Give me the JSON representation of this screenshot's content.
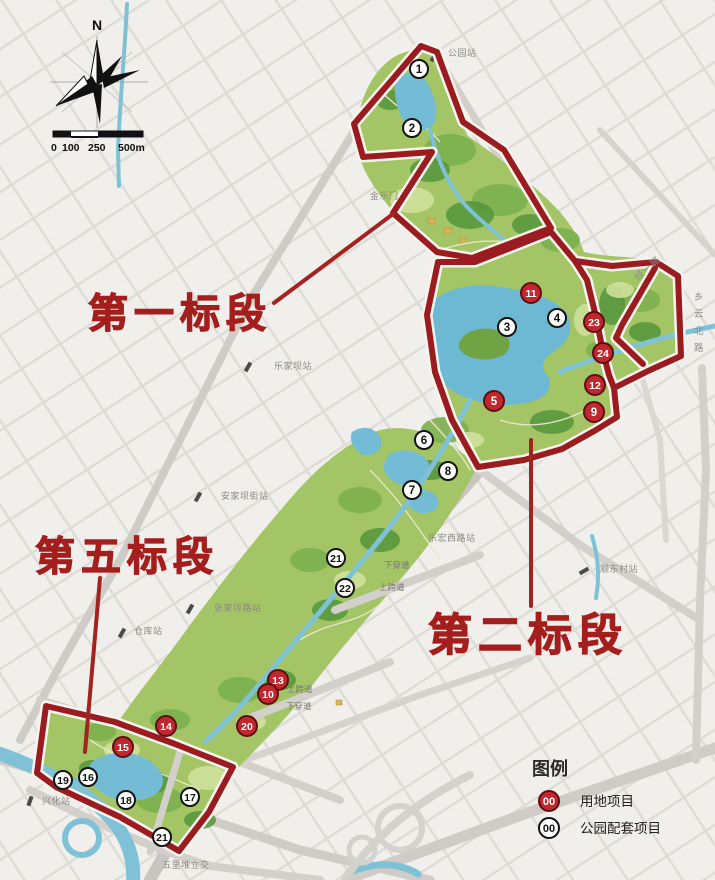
{
  "map_title": "公园建设标段划分图",
  "section_labels": [
    {
      "id": "section-1",
      "text": "第一标段",
      "x": 88,
      "y": 327,
      "size": 40
    },
    {
      "id": "section-5",
      "text": "第五标段",
      "x": 35,
      "y": 570,
      "size": 40
    },
    {
      "id": "section-2",
      "text": "第二标段",
      "x": 428,
      "y": 650,
      "size": 44
    }
  ],
  "compass": {
    "north": "N"
  },
  "scale_bar": {
    "ticks": [
      "0",
      "100",
      "250",
      "500m"
    ]
  },
  "legend": {
    "title": "图例",
    "items": [
      {
        "symbol": "00",
        "label": "用地项目",
        "style": "red"
      },
      {
        "symbol": "00",
        "label": "公园配套项目",
        "style": "white"
      }
    ]
  },
  "markers": {
    "red": [
      {
        "n": "11",
        "x": 531,
        "y": 293
      },
      {
        "n": "23",
        "x": 594,
        "y": 322
      },
      {
        "n": "24",
        "x": 603,
        "y": 353
      },
      {
        "n": "12",
        "x": 595,
        "y": 385
      },
      {
        "n": "9",
        "x": 594,
        "y": 412
      },
      {
        "n": "5",
        "x": 494,
        "y": 401
      },
      {
        "n": "13",
        "x": 278,
        "y": 680
      },
      {
        "n": "10",
        "x": 268,
        "y": 694
      },
      {
        "n": "20",
        "x": 247,
        "y": 726
      },
      {
        "n": "14",
        "x": 166,
        "y": 726
      },
      {
        "n": "15",
        "x": 123,
        "y": 747
      }
    ],
    "white": [
      {
        "n": "1",
        "x": 419,
        "y": 69
      },
      {
        "n": "2",
        "x": 412,
        "y": 128
      },
      {
        "n": "3",
        "x": 507,
        "y": 327
      },
      {
        "n": "4",
        "x": 557,
        "y": 318
      },
      {
        "n": "6",
        "x": 424,
        "y": 440
      },
      {
        "n": "8",
        "x": 448,
        "y": 471
      },
      {
        "n": "7",
        "x": 412,
        "y": 490
      },
      {
        "n": "21",
        "x": 336,
        "y": 558
      },
      {
        "n": "22",
        "x": 345,
        "y": 588
      },
      {
        "n": "19",
        "x": 63,
        "y": 780
      },
      {
        "n": "16",
        "x": 88,
        "y": 777
      },
      {
        "n": "18",
        "x": 126,
        "y": 800
      },
      {
        "n": "17",
        "x": 190,
        "y": 797
      },
      {
        "n": "21",
        "x": 162,
        "y": 837
      }
    ]
  },
  "station_labels": [
    {
      "text": "公园站",
      "x": 448,
      "y": 56
    },
    {
      "text": "金乐门",
      "x": 370,
      "y": 199
    },
    {
      "text": "乐家坝站",
      "x": 274,
      "y": 369
    },
    {
      "text": "安家坝街站",
      "x": 221,
      "y": 499
    },
    {
      "text": "乐宏西路站",
      "x": 428,
      "y": 541
    },
    {
      "text": "顺东村站",
      "x": 600,
      "y": 572
    },
    {
      "text": "张家坪路站",
      "x": 214,
      "y": 611
    },
    {
      "text": "仓库站",
      "x": 134,
      "y": 634
    },
    {
      "text": "兴化站",
      "x": 42,
      "y": 804
    },
    {
      "text": "五里堆立交",
      "x": 162,
      "y": 868
    }
  ],
  "road_labels": [
    {
      "text": "乡云北路",
      "x": 694,
      "y": 300,
      "vertical": true
    },
    {
      "text": "经一路",
      "x": 638,
      "y": 281,
      "rotate": -42
    }
  ],
  "passage_labels": [
    {
      "text": "下穿道",
      "x": 384,
      "y": 568
    },
    {
      "text": "上跨道",
      "x": 379,
      "y": 590
    },
    {
      "text": "上跨道",
      "x": 287,
      "y": 692
    },
    {
      "text": "下穿道",
      "x": 286,
      "y": 709
    }
  ],
  "colors": {
    "section_red": "#a31e1c",
    "boundary_red": "#9b1c20",
    "marker_red": "#c1272d",
    "park_green": "#a3c566",
    "water_blue": "#6db8d3"
  }
}
